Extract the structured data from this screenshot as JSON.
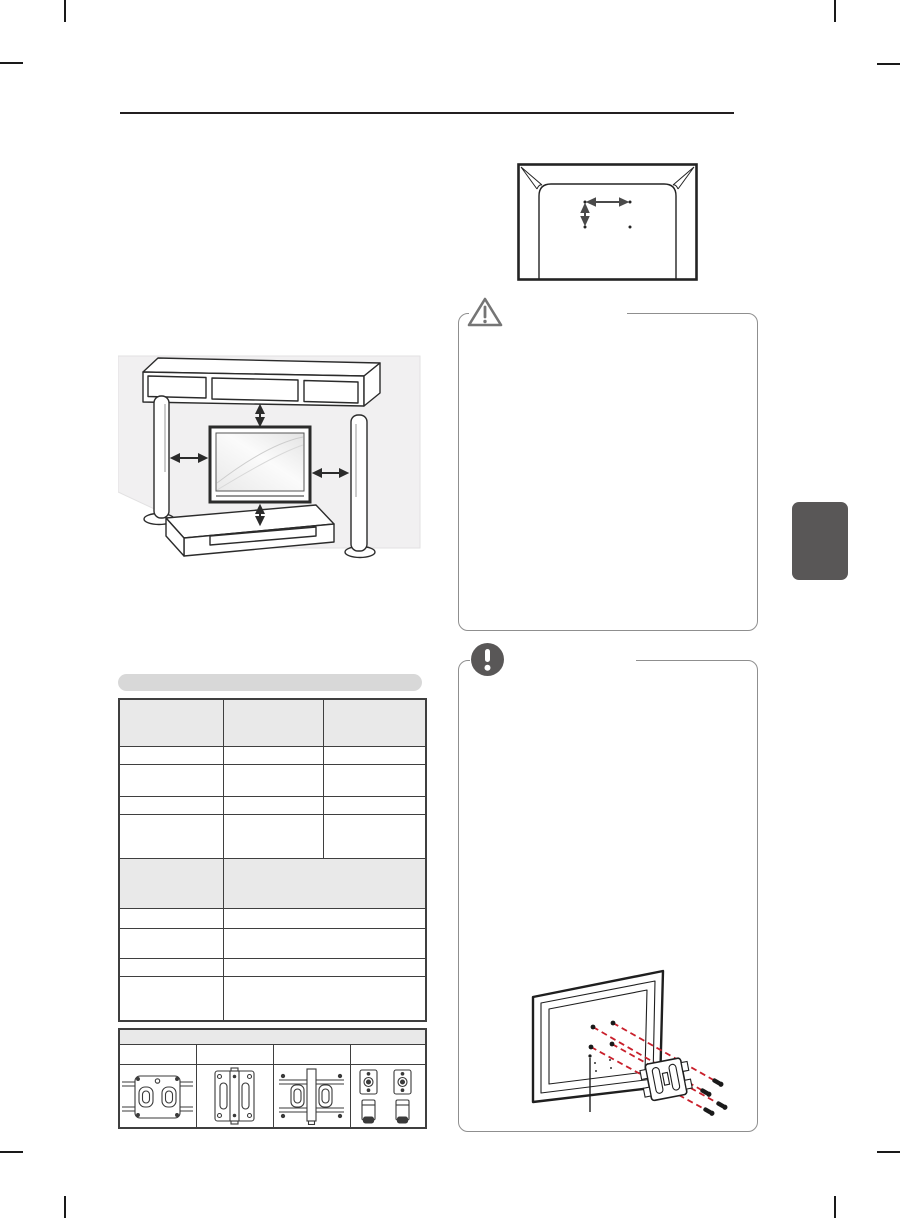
{
  "page": {
    "width": 900,
    "height": 1218,
    "background": "#ffffff"
  },
  "colors": {
    "crop_mark": "#1a1a1a",
    "header_rule": "#231f20",
    "callout_border": "#8f8f8f",
    "icon_gray": "#595757",
    "section_tab": "#595757",
    "table_border": "#3f3f3f",
    "table_header_fill": "#e9e9e9",
    "section_pill_fill": "#d8d8d8",
    "wall_fill": "#f1f0f1",
    "line_art": "#2b2b2b",
    "screw_guide_red": "#c9202c"
  },
  "header": {
    "title": ""
  },
  "figures": {
    "vesa_pattern": {
      "name": "tv-rear-vesa-hole-pattern",
      "holes": 4,
      "width_label": "",
      "height_label": ""
    },
    "clearance": {
      "name": "wall-mount-clearance-with-furniture",
      "clearance_arrows": 4
    },
    "bracket_attach": {
      "name": "tv-rear-bracket-screw-alignment",
      "screw_guides": 4,
      "pointer_label": ""
    }
  },
  "caution_box": {
    "icon": "caution-triangle-icon",
    "title": "",
    "body": ""
  },
  "note_box": {
    "icon": "note-exclamation-icon",
    "title": "",
    "body": ""
  },
  "spec_section": {
    "pill_label": "",
    "upper": {
      "columns": [
        "",
        "",
        ""
      ],
      "rows": [
        [
          "",
          "",
          ""
        ],
        [
          "",
          "",
          ""
        ],
        [
          "",
          "",
          ""
        ],
        [
          "",
          "",
          ""
        ]
      ]
    },
    "lower": {
      "columns": [
        "",
        ""
      ],
      "rows": [
        [
          "",
          ""
        ],
        [
          "",
          ""
        ],
        [
          "",
          ""
        ],
        [
          "",
          ""
        ]
      ]
    }
  },
  "bracket_table": {
    "title": "",
    "models": [
      "",
      "",
      "",
      ""
    ],
    "images": [
      "wall-bracket-rail-type",
      "wall-bracket-plate-type",
      "wall-bracket-column-type",
      "wall-bracket-spacers"
    ]
  },
  "side_tab": {
    "label": ""
  }
}
